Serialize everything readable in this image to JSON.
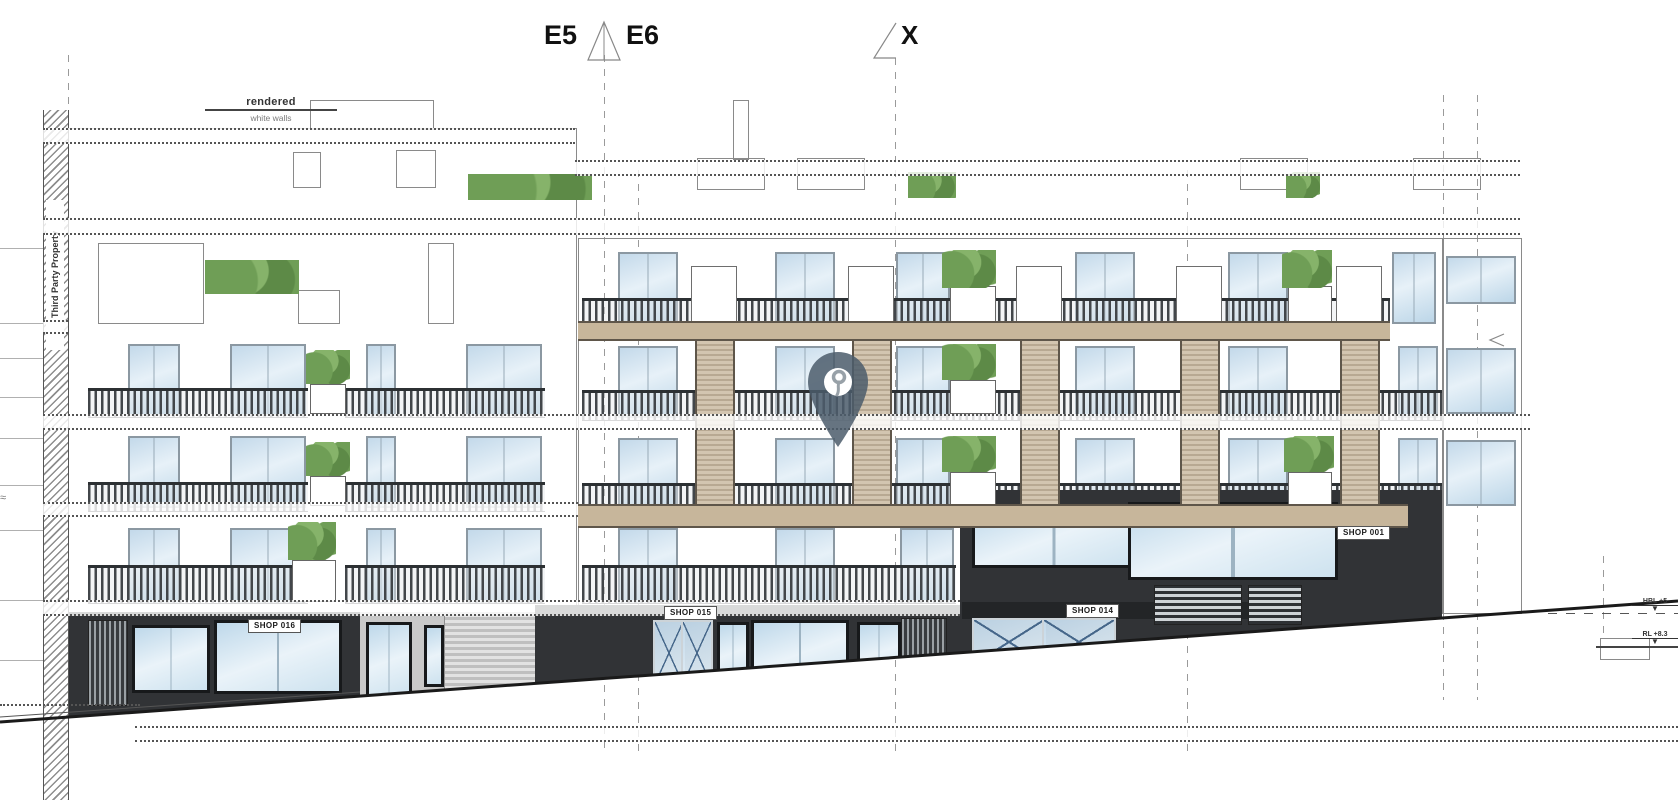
{
  "drawing": {
    "type": "street elevation",
    "section_markers": {
      "left": "E5",
      "right": "E6",
      "x": "X"
    },
    "note": {
      "line1": "rendered",
      "line2": "white walls"
    },
    "side_label": "Third Party Property",
    "approx_symbol": "≈"
  },
  "shops": [
    {
      "label": "SHOP 016"
    },
    {
      "label": "SHOP 015"
    },
    {
      "label": "SHOP 014"
    },
    {
      "label": "SHOP 001"
    }
  ],
  "levels": [
    {
      "label": "HBL +5",
      "marker": "▼"
    },
    {
      "label": "RL +8.3",
      "marker": "▼"
    }
  ],
  "colors": {
    "pin": "#4b5c6b",
    "timber_slab": "#c7b69b",
    "glass": "#c3d9ea",
    "dark_facade": "#313336",
    "plant_green": "#6f9e56"
  }
}
